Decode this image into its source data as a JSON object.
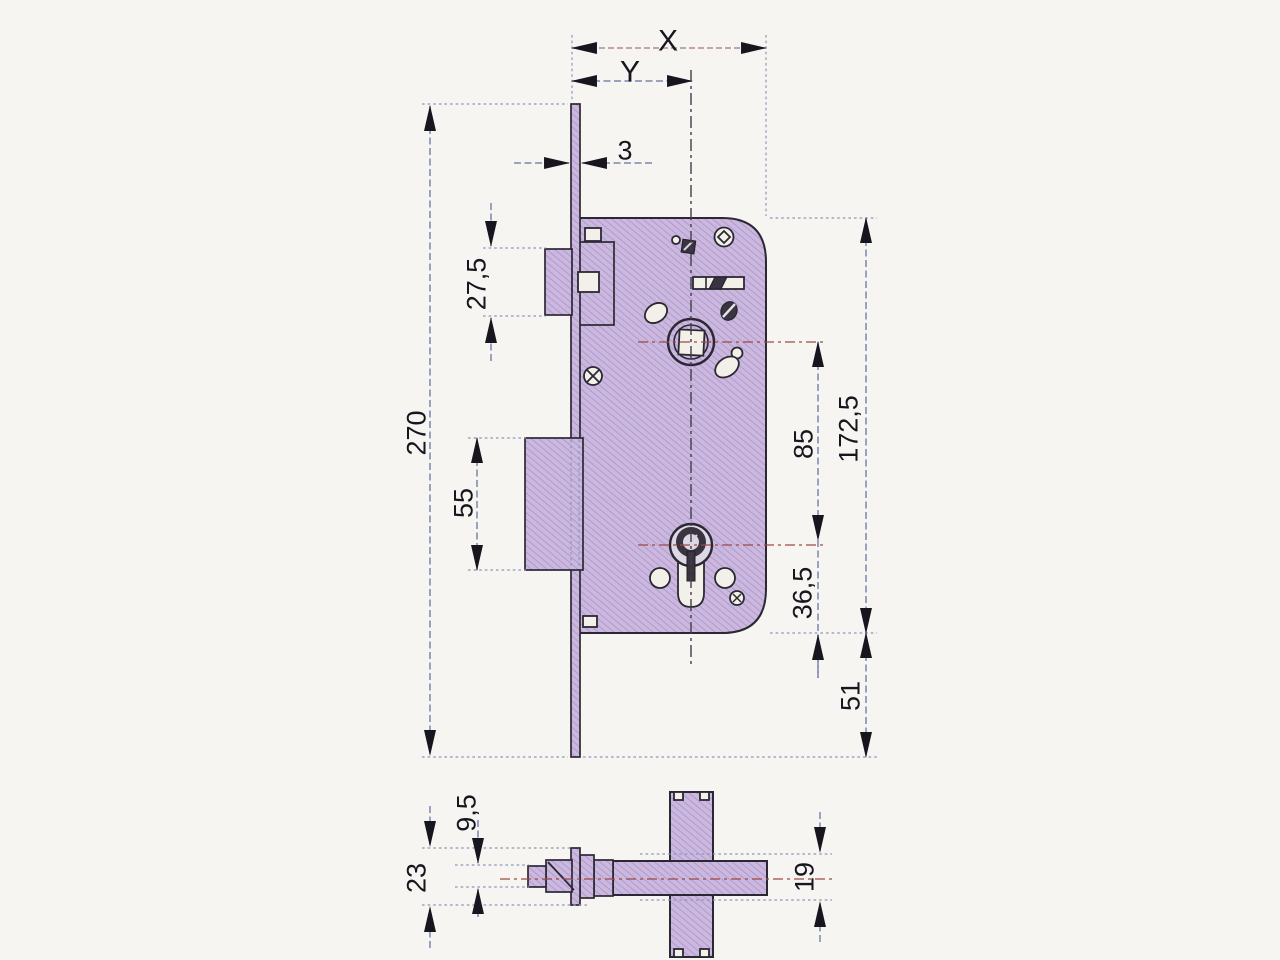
{
  "drawing": {
    "kind": "mortise-lock-dimensional-drawing",
    "colors": {
      "paper": "#f7f5f1",
      "part_fill": "#cbb8de",
      "part_hatch": "#ab8fc8",
      "outline": "#2b2833",
      "dimension_line": "#7c86ae",
      "centerline_red": "#9a4a44",
      "label_text": "#17151e"
    }
  },
  "dims": {
    "backset_full": "X",
    "backset_axis": "Y",
    "faceplate_thickness": "3",
    "latch_front_height": "27,5",
    "faceplate_length": "270",
    "deadbolt_front_height": "55",
    "follower_to_cylinder": "85",
    "case_height": "172,5",
    "cylinder_to_case_bottom": "36,5",
    "case_to_plate_end": "51",
    "latch_depth": "9,5",
    "plate_width_side": "23",
    "case_depth_side": "19"
  }
}
